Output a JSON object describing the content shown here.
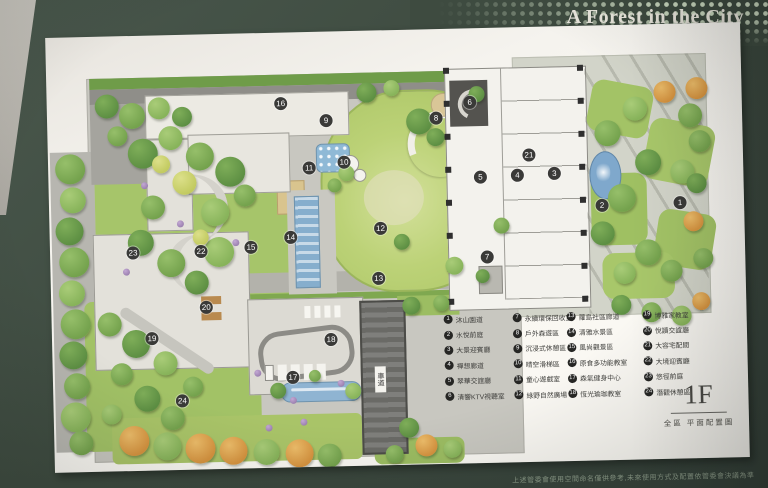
{
  "cover": {
    "title": "A Forest in the City",
    "disclaimer": "上述管委會使用空間命名僅供參考,未來使用方式及配置依管委會決議為準",
    "color": "#3e4b40"
  },
  "sheet": {
    "floor": "1F",
    "caption": "全區 平面配置圖",
    "driveway_label": "車道"
  },
  "colors": {
    "lawn": "#b5cd6f",
    "water": "#86aecd",
    "paving": "#c8c7c0",
    "cover_green": "#3e4b40"
  },
  "legend": {
    "items": [
      {
        "n": "1",
        "label": "沐山園道"
      },
      {
        "n": "2",
        "label": "水悅前庭"
      },
      {
        "n": "3",
        "label": "大景迎賓廳"
      },
      {
        "n": "4",
        "label": "禪想廊道"
      },
      {
        "n": "5",
        "label": "翠華交誼廳"
      },
      {
        "n": "6",
        "label": "清響KTV視聽室"
      },
      {
        "n": "7",
        "label": "永續環保回收室"
      },
      {
        "n": "8",
        "label": "戶外森遊區"
      },
      {
        "n": "9",
        "label": "沉浸式休憩區"
      },
      {
        "n": "10",
        "label": "晴空滑梯區"
      },
      {
        "n": "11",
        "label": "童心遊戲室"
      },
      {
        "n": "12",
        "label": "綠野自然廣場"
      },
      {
        "n": "13",
        "label": "蘿島社區廊道"
      },
      {
        "n": "14",
        "label": "清雅水景區"
      },
      {
        "n": "15",
        "label": "風尚觀景區"
      },
      {
        "n": "16",
        "label": "原食多功能教室"
      },
      {
        "n": "17",
        "label": "森氣健身中心"
      },
      {
        "n": "18",
        "label": "恆光瑜珈教室"
      },
      {
        "n": "19",
        "label": "博雅家教室"
      },
      {
        "n": "20",
        "label": "悅讀交誼廳"
      },
      {
        "n": "21",
        "label": "大容宅配間"
      },
      {
        "n": "22",
        "label": "大境迎賓廳"
      },
      {
        "n": "23",
        "label": "悠徑前庭"
      },
      {
        "n": "24",
        "label": "潛觀休憩區"
      }
    ]
  },
  "plan": {
    "markers": [
      {
        "n": "1",
        "x": 631,
        "y": 179
      },
      {
        "n": "2",
        "x": 553,
        "y": 180
      },
      {
        "n": "3",
        "x": 506,
        "y": 147
      },
      {
        "n": "4",
        "x": 469,
        "y": 148
      },
      {
        "n": "5",
        "x": 432,
        "y": 149
      },
      {
        "n": "6",
        "x": 423,
        "y": 74
      },
      {
        "n": "7",
        "x": 437,
        "y": 229
      },
      {
        "n": "8",
        "x": 389,
        "y": 89
      },
      {
        "n": "9",
        "x": 279,
        "y": 89
      },
      {
        "n": "10",
        "x": 296,
        "y": 131
      },
      {
        "n": "11",
        "x": 261,
        "y": 136
      },
      {
        "n": "12",
        "x": 331,
        "y": 198
      },
      {
        "n": "13",
        "x": 328,
        "y": 248
      },
      {
        "n": "14",
        "x": 241,
        "y": 205
      },
      {
        "n": "15",
        "x": 201,
        "y": 214
      },
      {
        "n": "16",
        "x": 234,
        "y": 71
      },
      {
        "n": "17",
        "x": 240,
        "y": 345
      },
      {
        "n": "18",
        "x": 279,
        "y": 308
      },
      {
        "n": "19",
        "x": 100,
        "y": 303
      },
      {
        "n": "20",
        "x": 155,
        "y": 273
      },
      {
        "n": "21",
        "x": 481,
        "y": 128
      },
      {
        "n": "22",
        "x": 151,
        "y": 217
      },
      {
        "n": "23",
        "x": 83,
        "y": 217
      },
      {
        "n": "24",
        "x": 129,
        "y": 366
      }
    ]
  }
}
